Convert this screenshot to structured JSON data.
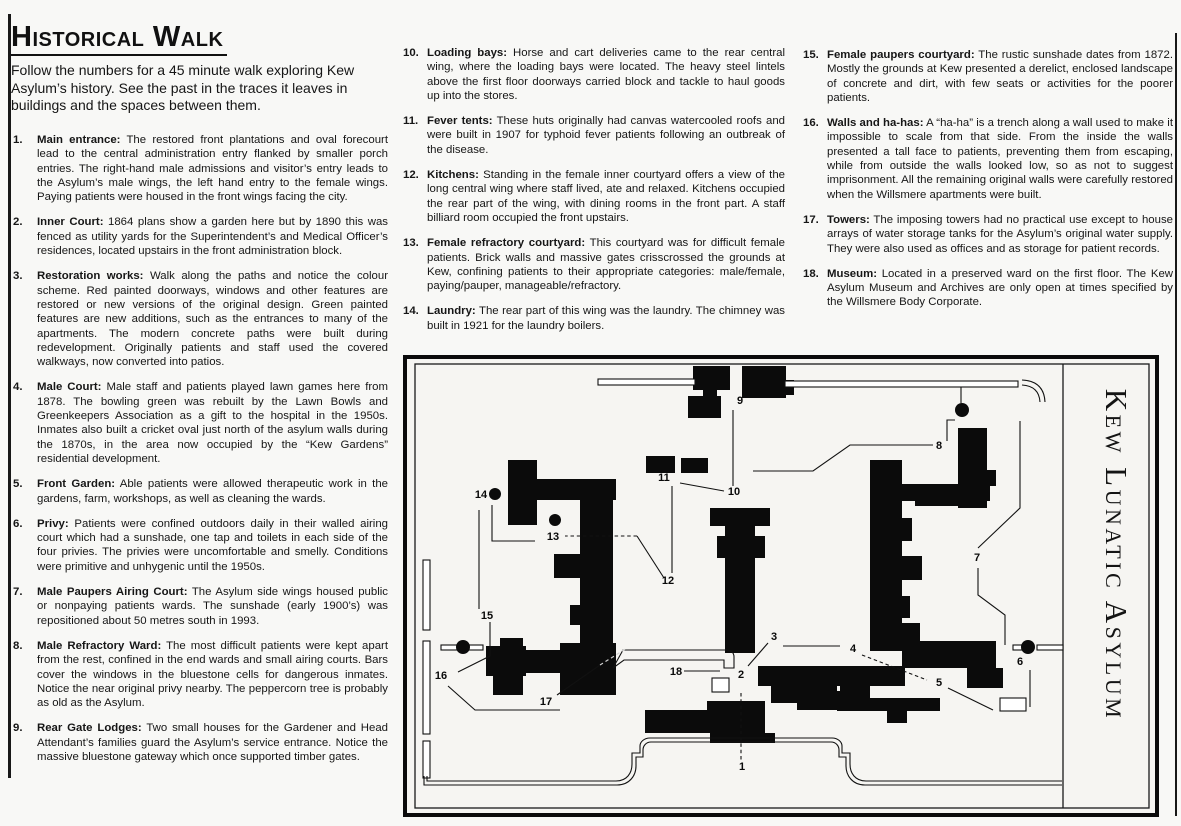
{
  "page": {
    "title": "Historical Walk",
    "intro": "Follow the numbers for a 45 minute walk exploring Kew Asylum’s history. See the past in the traces it leaves in buildings and the spaces between them."
  },
  "items": [
    {
      "num": "1.",
      "heading": "Main entrance:",
      "text": "The restored front plantations and oval forecourt lead to the central administration entry flanked by smaller porch entries.  The right-hand male admissions and visitor’s entry leads to the Asylum’s male wings, the left hand entry to the female wings.  Paying patients were housed in the front wings facing the city."
    },
    {
      "num": "2.",
      "heading": "Inner Court:",
      "text": "1864 plans show a garden here but by 1890 this was fenced as utility yards for the Superintendent’s and Medical Officer’s residences, located upstairs in the front administration block."
    },
    {
      "num": "3.",
      "heading": "Restoration works:",
      "text": "Walk along the paths and notice the colour scheme. Red painted doorways, windows and other features are restored or new versions of the original design. Green painted features are new additions, such as the entrances to many of the apartments. The modern concrete paths were built during redevelopment. Originally patients and staff used the covered walkways, now converted into patios."
    },
    {
      "num": "4.",
      "heading": "Male Court:",
      "text": "Male staff and patients played lawn games here from 1878.  The bowling green was rebuilt by the Lawn Bowls and Greenkeepers Association as a gift to the hospital in the 1950s.  Inmates also built a cricket oval just north of the asylum walls during the 1870s, in the area now occupied by the “Kew Gardens” residential development."
    },
    {
      "num": "5.",
      "heading": "Front Garden:",
      "text": "Able patients were allowed therapeutic work in the gardens, farm, workshops, as well as cleaning the wards."
    },
    {
      "num": "6.",
      "heading": "Privy:",
      "text": "Patients were confined outdoors daily in their walled airing court which had a sunshade, one tap and toilets in each side of the four privies.  The privies were uncomfortable and smelly.  Conditions were primitive and unhygenic until the 1950s."
    },
    {
      "num": "7.",
      "heading": "Male Paupers Airing Court:",
      "text": "The Asylum side wings housed public or nonpaying patients wards.  The sunshade (early 1900’s) was repositioned about 50 metres south in 1993."
    },
    {
      "num": "8.",
      "heading": "Male Refractory Ward:",
      "text": "The most difficult patients were kept apart from the rest, confined in the end wards and small airing courts. Bars cover the windows in the bluestone cells for dangerous inmates.  Notice the near original privy nearby.  The peppercorn tree is probably as old as the Asylum."
    },
    {
      "num": "9.",
      "heading": "Rear Gate Lodges:",
      "text": "Two small houses for the Gardener and Head Attendant’s families guard the Asylum’s service entrance. Notice the massive bluestone gateway which once supported timber gates."
    },
    {
      "num": "10.",
      "heading": "Loading bays:",
      "text": "Horse and cart deliveries came to the rear central wing, where the loading bays were located. The heavy steel lintels above the first floor doorways carried block and tackle to haul goods up into the stores."
    },
    {
      "num": "11.",
      "heading": "Fever tents:",
      "text": "These huts originally had canvas watercooled roofs and were built in 1907 for typhoid fever patients following an outbreak of the disease."
    },
    {
      "num": "12.",
      "heading": "Kitchens:",
      "text": "Standing in the female inner courtyard offers a view of the long central wing where staff lived, ate and relaxed. Kitchens occupied the rear part of the wing, with dining rooms in the front part. A staff billiard room occupied the front upstairs."
    },
    {
      "num": "13.",
      "heading": "Female refractory courtyard:",
      "text": "This courtyard was for difficult female patients. Brick walls and massive gates crisscrossed the grounds at Kew, confining patients to their appropriate categories: male/female, paying/pauper, manageable/refractory."
    },
    {
      "num": "14.",
      "heading": "Laundry:",
      "text": "The rear part of this wing was the laundry. The chimney was built in 1921 for the laundry boilers."
    },
    {
      "num": "15.",
      "heading": "Female paupers courtyard:",
      "text": "The rustic sunshade dates from 1872. Mostly the grounds at Kew presented a derelict, enclosed landscape of concrete and dirt, with few seats or activities for the poorer patients."
    },
    {
      "num": "16.",
      "heading": "Walls and ha-has:",
      "text": "A “ha-ha” is a trench along a wall used to make it impossible to scale from that side. From the inside the walls presented a tall face to patients, preventing them from escaping, while from outside the walls looked low, so as not to suggest imprisonment. All the remaining original walls were carefully restored when the Willsmere apartments were built."
    },
    {
      "num": "17.",
      "heading": "Towers:",
      "text": "The imposing towers had no practical use except to house arrays of water storage tanks for the Asylum’s original water supply.  They were also used as offices and as storage for patient records."
    },
    {
      "num": "18.",
      "heading": "Museum:",
      "text": "Located in a preserved ward on the first floor.  The Kew Asylum Museum and Archives are only open at times specified by the Willsmere Body Corporate."
    }
  ],
  "map": {
    "title": "Kew Lunatic Asylum",
    "labels": [
      {
        "n": "1",
        "x": 339,
        "y": 415
      },
      {
        "n": "2",
        "x": 338,
        "y": 323
      },
      {
        "n": "3",
        "x": 371,
        "y": 285
      },
      {
        "n": "4",
        "x": 450,
        "y": 297
      },
      {
        "n": "5",
        "x": 536,
        "y": 331
      },
      {
        "n": "6",
        "x": 617,
        "y": 310
      },
      {
        "n": "7",
        "x": 574,
        "y": 206
      },
      {
        "n": "8",
        "x": 536,
        "y": 94
      },
      {
        "n": "9",
        "x": 337,
        "y": 49
      },
      {
        "n": "10",
        "x": 331,
        "y": 140
      },
      {
        "n": "11",
        "x": 261,
        "y": 126
      },
      {
        "n": "12",
        "x": 265,
        "y": 229
      },
      {
        "n": "13",
        "x": 150,
        "y": 185
      },
      {
        "n": "14",
        "x": 78,
        "y": 143
      },
      {
        "n": "15",
        "x": 84,
        "y": 264
      },
      {
        "n": "16",
        "x": 38,
        "y": 324
      },
      {
        "n": "17",
        "x": 143,
        "y": 350
      },
      {
        "n": "18",
        "x": 273,
        "y": 320
      }
    ]
  }
}
